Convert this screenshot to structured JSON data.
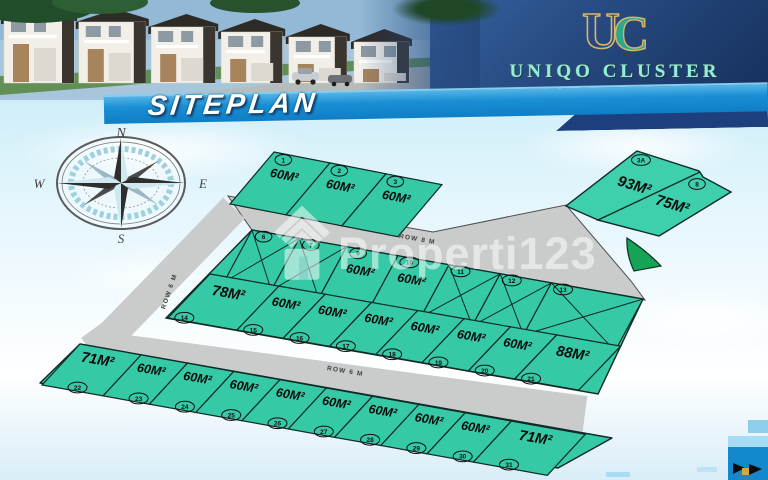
{
  "header": {
    "banner_title": "SITEPLAN",
    "monogram_left": "U",
    "monogram_right": "C",
    "brand_name": "UNIQO CLUSTER",
    "brand_sub": "SERPONG"
  },
  "compass": {
    "north": "N",
    "east": "E",
    "south": "S",
    "west": "W"
  },
  "watermark": {
    "text": "Properti123",
    "icon": "house-roof-icon"
  },
  "roads": [
    {
      "id": "row8m-top",
      "label": "ROW 8 M"
    },
    {
      "id": "row6m-left",
      "label": "ROW 6 M"
    },
    {
      "id": "row6m-mid",
      "label": "ROW 6 M"
    }
  ],
  "siteplan": {
    "rows": [
      {
        "name": "top-row",
        "lots": [
          {
            "no": "1",
            "size": "60M²",
            "status": "available"
          },
          {
            "no": "2",
            "size": "60M²",
            "status": "available"
          },
          {
            "no": "3",
            "size": "60M²",
            "status": "available"
          }
        ]
      },
      {
        "name": "ne-block",
        "lots": [
          {
            "no": "3A",
            "size": "93M²",
            "status": "available"
          },
          {
            "no": "8",
            "size": "75M²",
            "status": "available"
          }
        ]
      },
      {
        "name": "middle-upper",
        "lots": [
          {
            "no": "6",
            "size": "",
            "status": "sold"
          },
          {
            "no": "7",
            "size": "",
            "status": "sold"
          },
          {
            "no": "9",
            "size": "60M²",
            "status": "available"
          },
          {
            "no": "10",
            "size": "60M²",
            "status": "available"
          },
          {
            "no": "11",
            "size": "",
            "status": "sold"
          },
          {
            "no": "12",
            "size": "",
            "status": "sold"
          },
          {
            "no": "13",
            "size": "",
            "status": "sold"
          }
        ]
      },
      {
        "name": "middle-lower",
        "lots": [
          {
            "no": "14",
            "size": "78M²",
            "status": "available"
          },
          {
            "no": "15",
            "size": "60M²",
            "status": "available"
          },
          {
            "no": "16",
            "size": "60M²",
            "status": "available"
          },
          {
            "no": "17",
            "size": "60M²",
            "status": "available"
          },
          {
            "no": "18",
            "size": "60M²",
            "status": "available"
          },
          {
            "no": "19",
            "size": "60M²",
            "status": "available"
          },
          {
            "no": "20",
            "size": "60M²",
            "status": "available"
          },
          {
            "no": "21",
            "size": "88M²",
            "status": "available"
          }
        ]
      },
      {
        "name": "bottom-row",
        "lots": [
          {
            "no": "22",
            "size": "71M²",
            "status": "available"
          },
          {
            "no": "23",
            "size": "60M²",
            "status": "available"
          },
          {
            "no": "24",
            "size": "60M²",
            "status": "available"
          },
          {
            "no": "25",
            "size": "60M²",
            "status": "available"
          },
          {
            "no": "26",
            "size": "60M²",
            "status": "available"
          },
          {
            "no": "27",
            "size": "60M²",
            "status": "available"
          },
          {
            "no": "28",
            "size": "60M²",
            "status": "available"
          },
          {
            "no": "29",
            "size": "60M²",
            "status": "available"
          },
          {
            "no": "30",
            "size": "60M²",
            "status": "available"
          },
          {
            "no": "31",
            "size": "71M²",
            "status": "available"
          }
        ]
      }
    ]
  },
  "colors": {
    "lot_teal": "#36c9a6",
    "lot_teal_light": "#3ed0ad",
    "green_wedge": "#17a356",
    "road_gray": "#c9cccb",
    "road_edge": "#4d4d4d",
    "lot_stroke": "#0e2b26",
    "header_navy": "#1d3c70",
    "ribbon_blue": "#1689cf",
    "ribbon_shadow_navy": "#1d3f7e",
    "brand_mint": "#8ef0d8",
    "brand_gold": "#d9b56b",
    "footer_blue": "#1488cc"
  }
}
